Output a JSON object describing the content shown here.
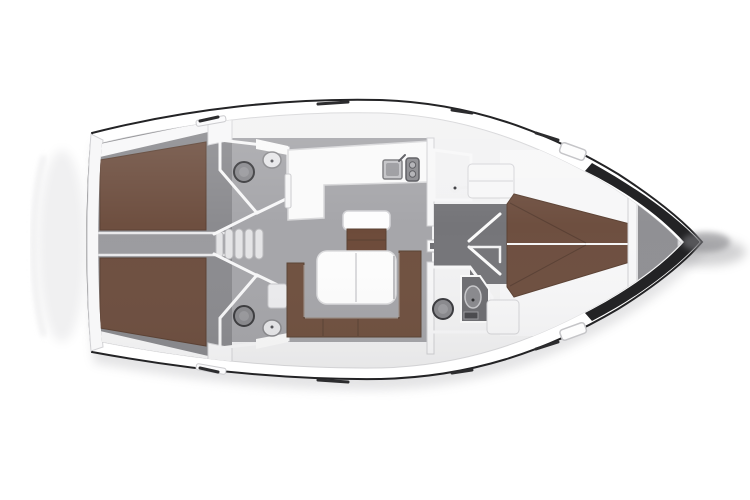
{
  "canvas": {
    "width": 750,
    "height": 500,
    "background_color": "#ffffff"
  },
  "colors": {
    "hull_outline": "#232325",
    "hull_white": "#ffffff",
    "interior_base": "#f2f2f3",
    "wall_white": "#f7f7f8",
    "counter_white": "#fafafa",
    "table_white": "#fdfdfd",
    "floor_salon": "#a6a6aa",
    "floor_cabin": "#8b8b8f",
    "floor_corridor": "#9b9b9f",
    "floor_passage": "#757579",
    "head_dark": "#5a5a5e",
    "shower_tray": "#6e6e72",
    "bed_brown": "#6e4f40",
    "settee_brown": "#705140",
    "bench_brown": "#6d4b3a",
    "fixture_light": "#e7e7e9",
    "fixture_gray": "#8a8a8e",
    "anchor_gray": "#909094",
    "window_dark": "#2c2c2e",
    "shadow_soft": "#c3c3c6",
    "bow_shadow": "#808084",
    "step_tread": "#e4e4e6"
  }
}
